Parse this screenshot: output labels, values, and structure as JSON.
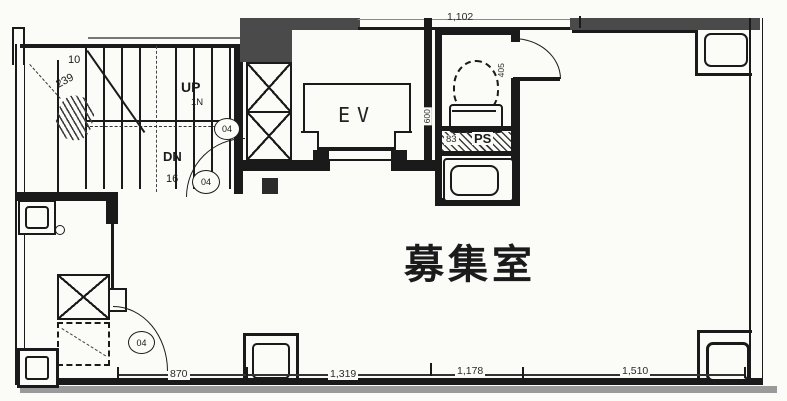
{
  "plan": {
    "room_label": "募集室",
    "elevator_label": "EV",
    "stairs": {
      "up_label": "UP",
      "up_count": "1N",
      "dn_label": "DN",
      "dn_count": "16",
      "dim_a": "10",
      "dim_b": "239"
    },
    "toilet": {
      "ps_label": "PS",
      "ps_dim": "83",
      "dim_width": "600",
      "dim_depth": "405"
    },
    "dims": {
      "top": "1,102",
      "bottom": [
        "870",
        "1,319",
        "1,178",
        "1,510"
      ]
    },
    "door_tags": [
      "04",
      "04",
      "04"
    ],
    "colors": {
      "line": "#1a1a1a",
      "wall_fill": "#4a4a4a",
      "shadow": "#9a9a9a",
      "paper": "#fbfbf8"
    }
  }
}
